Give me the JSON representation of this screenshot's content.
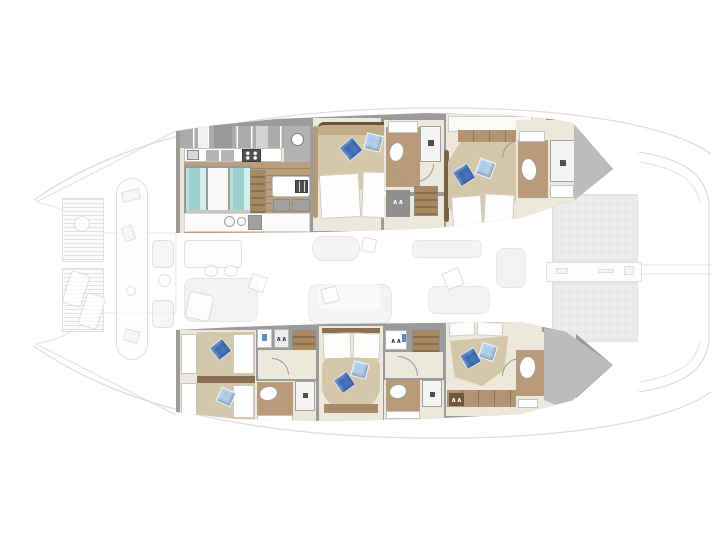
{
  "diagram": {
    "type": "floor-plan",
    "subject": "catamaran interior layout, top-down view",
    "rendering": "solid accommodation deck over ghosted main deck",
    "hulls": [
      {
        "id": "starboard",
        "position": "top",
        "rooms": [
          {
            "name": "galley",
            "features": [
              "overhead-cabinets",
              "cooktop",
              "counter-appliances",
              "extractor-fan",
              "fridge-freezer-units",
              "island-with-sink",
              "aft-counter-double-sink",
              "companionway-stairs",
              "teak-floor"
            ]
          },
          {
            "name": "double-cabin-mid",
            "features": [
              "double-bed",
              "dark-blue-pillow",
              "light-blue-pillow",
              "ensuite-toilet",
              "ensuite-shower",
              "vanity-sink",
              "wardrobe",
              "companionway-stairs"
            ]
          },
          {
            "name": "double-cabin-aft",
            "features": [
              "double-bed",
              "dark-blue-pillow",
              "light-blue-pillow",
              "ensuite-toilet",
              "ensuite-shower",
              "vanity-sink",
              "shelf"
            ]
          }
        ]
      },
      {
        "id": "port",
        "position": "bottom",
        "rooms": [
          {
            "name": "twin-cabin-forward",
            "features": [
              "two-single-beds",
              "dark-blue-pillow",
              "light-blue-pillow",
              "ensuite-toilet",
              "ensuite-shower",
              "vanity-sink",
              "wardrobe",
              "companionway-stairs"
            ]
          },
          {
            "name": "double-cabin-mid",
            "features": [
              "double-bed",
              "dark-blue-pillow",
              "light-blue-pillow",
              "ensuite-toilet",
              "ensuite-shower",
              "vanity-sink",
              "wardrobe",
              "companionway-stairs"
            ]
          },
          {
            "name": "double-cabin-aft",
            "features": [
              "double-bed",
              "dark-blue-pillow",
              "light-blue-pillow",
              "ensuite-toilet",
              "ensuite-shower",
              "vanity-sink",
              "shelf"
            ]
          }
        ]
      }
    ],
    "ghosted_deck_elements": [
      "bow-trampolines",
      "bow-hatch",
      "foredeck-loungers",
      "foredeck-seats",
      "bow-center-walkway",
      "saloon-dining-table",
      "saloon-chairs",
      "saloon-sofa",
      "cockpit-table",
      "cockpit-sofa",
      "aft-benches",
      "scatter-cushions",
      "transom-platforms",
      "stern-walkway",
      "davit-lines"
    ],
    "counts": {
      "cabins": 5,
      "bathrooms": 5,
      "double_beds": 4,
      "single_beds": 2,
      "blue_pillows": 10,
      "stair-flights": 4,
      "trampoline_panels": 2
    }
  },
  "palette": {
    "wall": "#9b9b99",
    "floor_cream": "#ede8dc",
    "wood": "#bb9e7d",
    "wood_dark": "#a98a66",
    "brown_floor": "#b99b79",
    "bed_tan": "#d3c6a9",
    "headboard_tan": "#c2ab88",
    "headboard_dark": "#6b5138",
    "rail_brown": "#b59877",
    "rail_dark": "#7a6044",
    "frame_brown": "#8a6f50",
    "shelf_wood": "#b29474",
    "stair_light": "#a8895f",
    "stair_dark": "#8a6f4e",
    "pillow_dark_1": "#27549c",
    "pillow_dark_2": "#5b8cd0",
    "pillow_light_1": "#8fb9e4",
    "pillow_light_2": "#cfe3f4",
    "fridge_cyan": "#a9d7d7",
    "cabinet_gray": "#ababa9",
    "appliance_dark": "#50504e",
    "fixture_gray": "#9e9e9c",
    "wedge_gray": "#bcbcba",
    "ghost_line": "#d6d6d3",
    "ghost_fill": "#f0f0ed",
    "transom_fill": "#e8e8e6"
  }
}
